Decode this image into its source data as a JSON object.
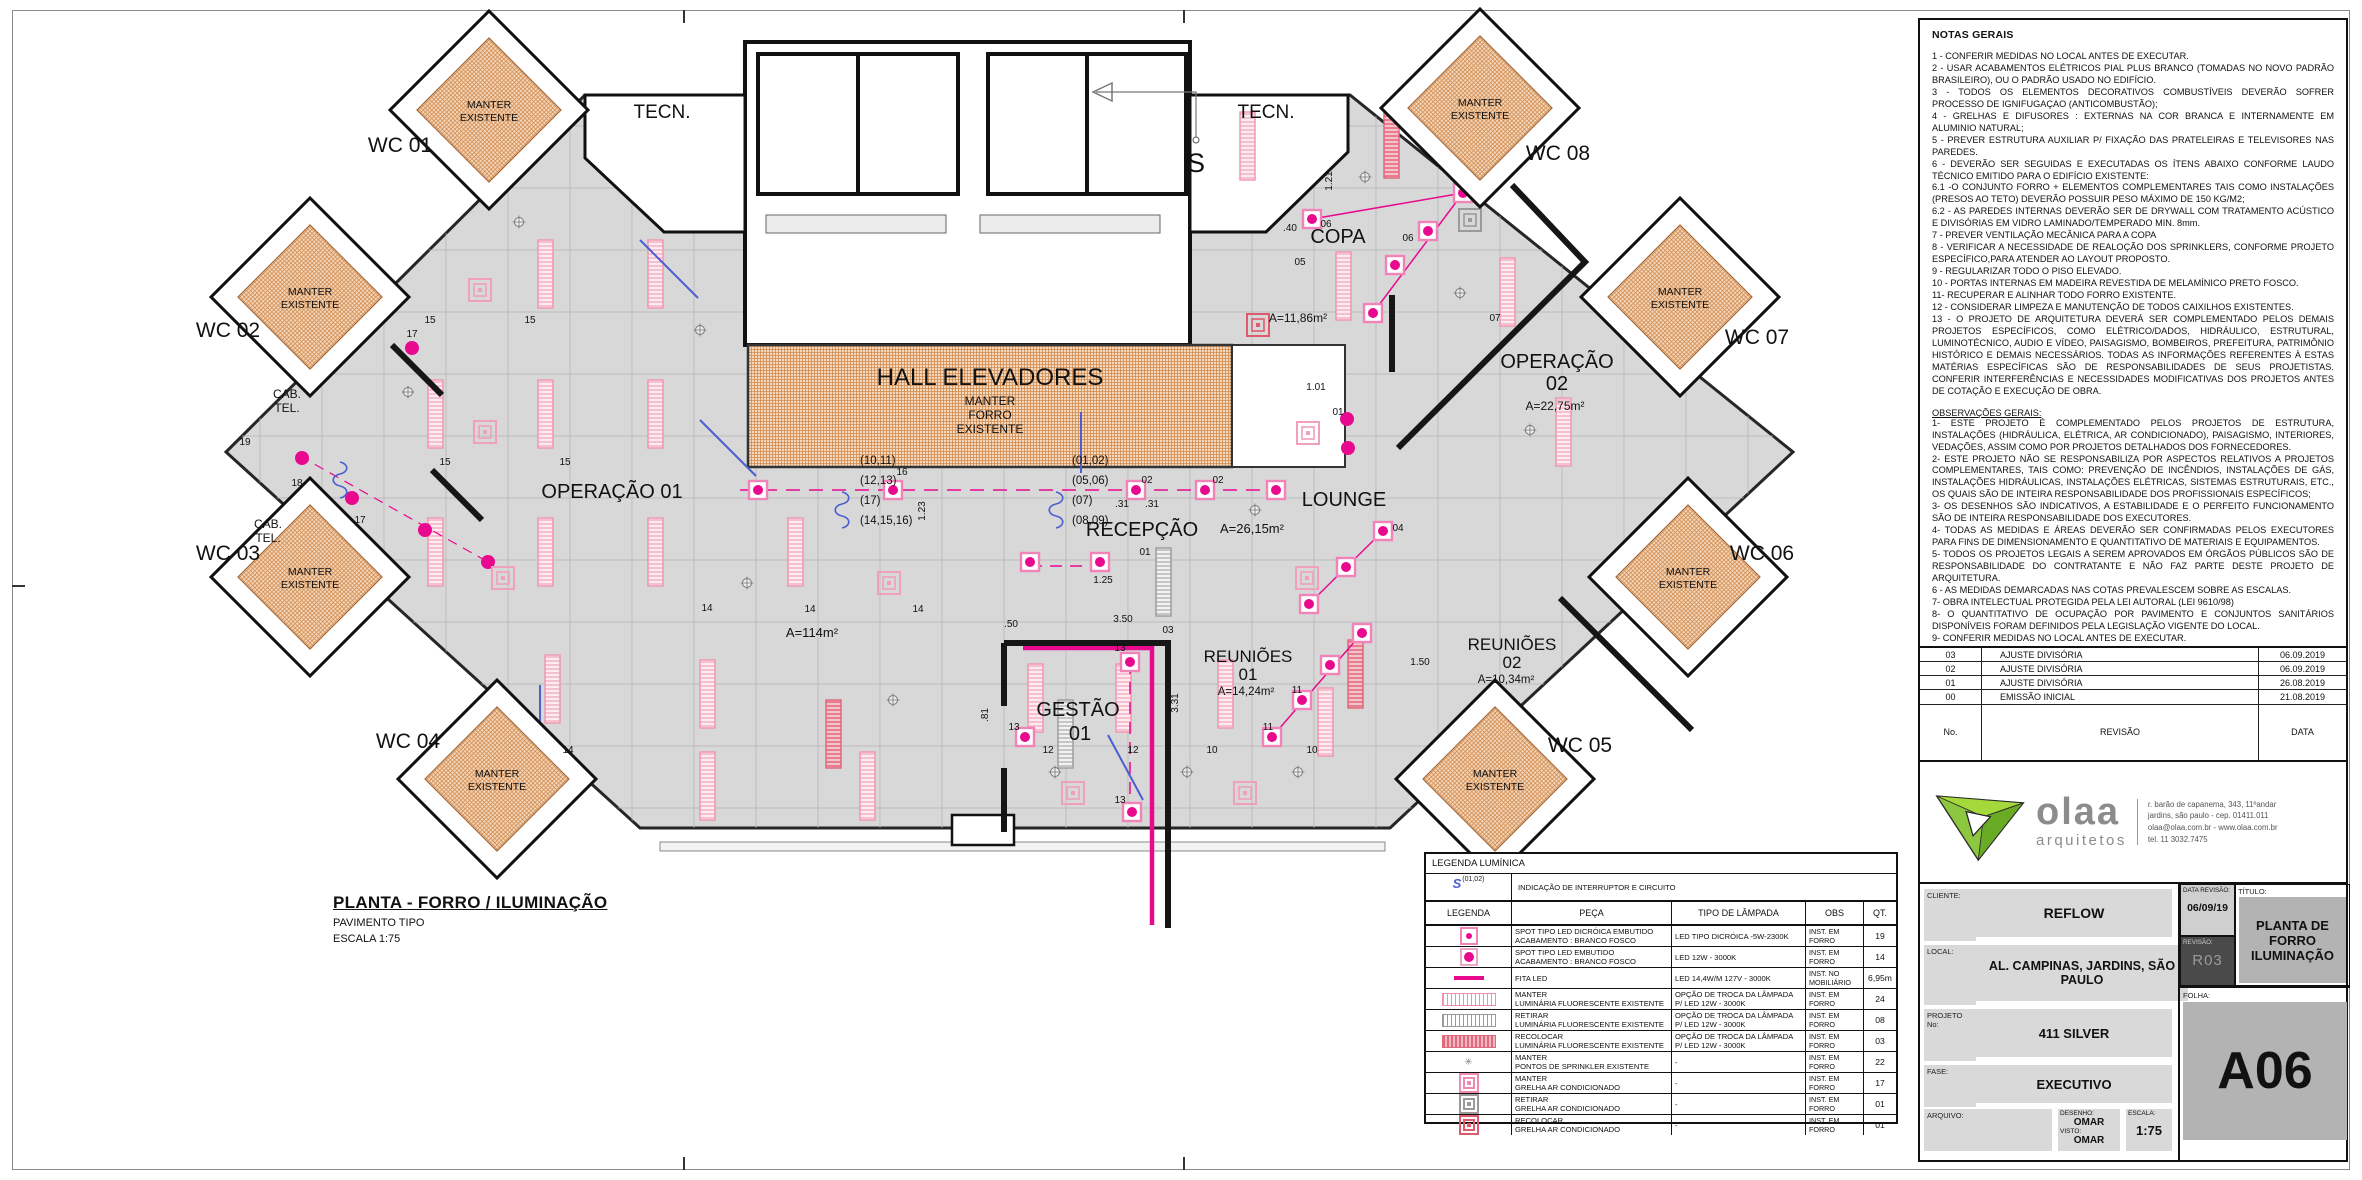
{
  "colors": {
    "magenta": "#e8098e",
    "pink_fixture": "#ef93ac",
    "orange_hatch": "#d08a4e",
    "switch_blue": "#4a5fd0",
    "logo_green": "#8dc63f"
  },
  "sheet": {
    "plan_title": "PLANTA - FORRO / ILUMINAÇÃO",
    "plan_subtitle": "PAVIMENTO TIPO",
    "plan_scale": "ESCALA 1:75"
  },
  "notes": {
    "title": "NOTAS GERAIS",
    "items": [
      "1 - CONFERIR MEDIDAS NO LOCAL ANTES DE EXECUTAR.",
      "2 - USAR ACABAMENTOS ELÉTRICOS PIAL PLUS BRANCO (TOMADAS NO NOVO PADRÃO BRASILEIRO), OU O PADRÃO USADO NO EDIFÍCIO.",
      "3 - TODOS OS ELEMENTOS DECORATIVOS COMBUSTÍVEIS DEVERÃO SOFRER PROCESSO DE IGNIFUGAÇAO (ANTICOMBUSTÃO);",
      "4 - GRELHAS E DIFUSORES :  EXTERNAS NA COR BRANCA E INTERNAMENTE EM ALUMINIO NATURAL;",
      "5 - PREVER ESTRUTURA AUXILIAR P/ FIXAÇÃO DAS PRATELEIRAS E TELEVISORES NAS PAREDES.",
      "6 - DEVERÃO SER SEGUIDAS E EXECUTADAS OS ÍTENS ABAIXO CONFORME  LAUDO TÉCNICO EMITIDO PARA O  EDIFÍCIO EXISTENTE:",
      "6.1 -O CONJUNTO  FORRO + ELEMENTOS COMPLEMENTARES TAIS COMO INSTALAÇÕES (PRESOS AO TETO) DEVERÃO POSSUIR PESO MÁXIMO DE 150 KG/M2;",
      "6.2 - AS PAREDES INTERNAS DEVERÃO SER DE DRYWALL COM TRATAMENTO ACÚSTICO E DIVISÓRIAS EM VIDRO LAMINADO/TEMPERADO MIN. 8mm.",
      "7 -  PREVER VENTILAÇÃO MECÂNICA PARA A COPA",
      "8 - VERIFICAR A NECESSIDADE DE REALOÇÃO DOS SPRINKLERS, CONFORME PROJETO ESPECÍFICO,PARA ATENDER AO LAYOUT PROPOSTO.",
      "9 - REGULARIZAR TODO O PISO ELEVADO.",
      "10 - PORTAS INTERNAS EM MADEIRA REVESTIDA DE MELAMÍNICO PRETO FOSCO.",
      "11- RECUPERAR E ALINHAR TODO FORRO EXISTENTE.",
      "12 - CONSIDERAR LIMPEZA E MANUTENÇÃO DE TODOS CAIXILHOS EXISTENTES.",
      "13 - O PROJETO DE ARQUITETURA DEVERÁ SER COMPLEMENTADO PELOS DEMAIS PROJETOS ESPECÍFICOS, COMO ELÉTRICO/DADOS, HIDRÁULICO, ESTRUTURAL, LUMINOTÉCNICO, AUDIO E VÍDEO, PAISAGISMO, BOMBEIROS, PREFEITURA, PATRIMÔNIO HISTÓRICO E DEMAIS NECESSÁRIOS. TODAS AS INFORMAÇÕES REFERENTES À ESTAS MATÉRIAS ESPECÍFICAS SÃO DE RESPONSABILIDADES DE SEUS PROJETISTAS. CONFERIR INTERFERÊNCIAS E NECESSIDADES MODIFICATIVAS DOS PROJETOS ANTES DE COTAÇÃO E EXECUÇÃO DE OBRA."
    ],
    "obs_title": "OBSERVAÇÕES GERAIS:",
    "obs_items": [
      "1-  ESTE PROJETO É COMPLEMENTADO PELOS PROJETOS DE ESTRUTURA, INSTALAÇÕES (HIDRÁULICA, ELÉTRICA, AR CONDICIONADO), PAISAGISMO, INTERIORES, VEDAÇÕES, ASSIM COMO POR PROJETOS DETALHADOS DOS FORNECEDORES.",
      "2- ESTE PROJETO NÃO SE RESPONSABILIZA POR ASPECTOS RELATIVOS A PROJETOS COMPLEMENTARES, TAIS COMO: PREVENÇÃO DE INCÊNDIOS, INSTALAÇÕES DE GÁS, INSTALAÇÕES HIDRÁULICAS, INSTALAÇÕES ELÉTRICAS, SISTEMAS ESTRUTURAIS, ETC., OS QUAIS SÃO DE INTEIRA RESPONSABILIDADE DOS PROFISSIONAIS ESPECÍFICOS;",
      "3-  OS DESENHOS SÃO INDICATIVOS, A ESTABILIDADE E O PERFEITO FUNCIONAMENTO SÃO DE INTEIRA RESPONSABILIDADE DOS EXECUTORES.",
      "4- TODAS AS MEDIDAS E ÁREAS DEVERÃO SER CONFIRMADAS PELOS EXECUTORES PARA FINS DE DIMENSIONAMENTO E QUANTITATIVO DE MATERIAIS  E EQUIPAMENTOS.",
      "5- TODOS OS PROJETOS LEGAIS A SEREM APROVADOS EM ÓRGÃOS PÚBLICOS SÃO DE RESPONSABILIDADE DO CONTRATANTE E NÃO FAZ PARTE DESTE PROJETO DE ARQUITETURA.",
      "6 -  AS MEDIDAS DEMARCADAS NAS COTAS PREVALESCEM SOBRE AS ESCALAS.",
      "7-  OBRA INTELECTUAL PROTEGIDA PELA LEI AUTORAL (LEI 9610/98)",
      "8- O QUANTITATIVO DE OCUPAÇÃO POR PAVIMENTO E CONJUNTOS SANITÁRIOS DISPONÍVEIS FORAM DEFINIDOS PELA LEGISLAÇÃO VIGENTE DO LOCAL.",
      "9-  CONFERIR MEDIDAS NO LOCAL ANTES DE EXECUTAR.",
      "10- AS QUANTIDADES DOS ITENS DEMONSTRADOS EM PLANTA, PREVALESCEM SOBRE QUANTITATIVOS DO MEMORIAL E LEGENDAS."
    ]
  },
  "revisions": {
    "rows": [
      {
        "no": "03",
        "desc": "AJUSTE  DIVISÓRIA",
        "date": "06.09.2019"
      },
      {
        "no": "02",
        "desc": "AJUSTE  DIVISÓRIA",
        "date": "06.09.2019"
      },
      {
        "no": "01",
        "desc": "AJUSTE  DIVISÓRIA",
        "date": "26.08.2019"
      },
      {
        "no": "00",
        "desc": "EMISSÃO INICIAL",
        "date": "21.08.2019"
      }
    ],
    "footer": {
      "no": "No.",
      "desc": "REVISÃO",
      "date": "DATA"
    }
  },
  "logo": {
    "name": "olaa",
    "sub": "arquitetos",
    "address_lines": [
      "r. barão de capanema, 343, 11ºandar",
      "jardins, são paulo - cep. 01411.011",
      "olaa@olaa.com.br - www.olaa.com.br",
      "tel. 11 3032.7475"
    ]
  },
  "titleblock": {
    "cliente_label": "CLIENTE:",
    "cliente": "REFLOW",
    "local_label": "LOCAL:",
    "local": "AL. CAMPINAS, JARDINS, SÃO PAULO",
    "projeto_label": "PROJETO No:",
    "projeto": "411 SILVER",
    "fase_label": "FASE:",
    "fase": "EXECUTIVO",
    "arquivo_label": "ARQUIVO:",
    "desenho_label": "DESENHO:",
    "desenho": "OMAR",
    "visto_label": "VISTO:",
    "visto": "OMAR",
    "escala_label": "ESCALA:",
    "escala": "1:75",
    "data_revisao_label": "DATA REVISÃO:",
    "data_revisao": "06/09/19",
    "revisao_label": "REVISÃO:",
    "revisao": "R03",
    "titulo_label": "TÍTULO:",
    "titulo": "PLANTA DE FORRO ILUMINAÇÃO",
    "folha_label": "FOLHA:",
    "folha": "A06"
  },
  "legend": {
    "title": "LEGENDA LUMÍNICA",
    "interruptor_symbol": "S",
    "interruptor_circuit": "(01,02)",
    "interruptor_desc": "INDICAÇÃO DE INTERRUPTOR E CIRCUITO",
    "headers": [
      "LEGENDA",
      "PEÇA",
      "TIPO DE LÂMPADA",
      "OBS",
      "QT."
    ],
    "rows": [
      {
        "icon": "spot-dicroica",
        "peca1": "SPOT TIPO LED DICRÓICA EMBUTIDO",
        "peca2": "ACABAMENTO : BRANCO FOSCO",
        "tipo": "LED TIPO DICRÓICA -5W-2300K",
        "obs": "INST. EM FORRO",
        "qt": "19"
      },
      {
        "icon": "spot-led",
        "peca1": "SPOT TIPO LED EMBUTIDO",
        "peca2": "ACABAMENTO : BRANCO FOSCO",
        "tipo": "LED 12W - 3000K",
        "obs": "INST. EM FORRO",
        "qt": "14"
      },
      {
        "icon": "fita-led",
        "peca1": "FITA LED",
        "peca2": "",
        "tipo": "LED 14,4W/M 127V - 3000K",
        "obs": "INST. NO MOBILIÁRIO",
        "qt": "6,95m"
      },
      {
        "icon": "fluor-manter",
        "peca1": "MANTER",
        "peca2": "LUMINÁRIA FLUORESCENTE EXISTENTE",
        "tipo": "OPÇÃO DE TROCA DA LÂMPADA P/ LED 12W - 3000K",
        "obs": "INST. EM FORRO",
        "qt": "24"
      },
      {
        "icon": "fluor-retirar",
        "peca1": "RETIRAR",
        "peca2": "LUMINÁRIA FLUORESCENTE EXISTENTE",
        "tipo": "OPÇÃO DE TROCA DA LÂMPADA P/ LED 12W - 3000K",
        "obs": "INST. EM FORRO",
        "qt": "08"
      },
      {
        "icon": "fluor-recolocar",
        "peca1": "RECOLOCAR",
        "peca2": "LUMINÁRIA FLUORESCENTE EXISTENTE",
        "tipo": "OPÇÃO DE TROCA DA LÂMPADA P/ LED 12W - 3000K",
        "obs": "INST. EM FORRO",
        "qt": "03"
      },
      {
        "icon": "sprinkler",
        "peca1": "MANTER",
        "peca2": "PONTOS DE SPRINKLER EXISTENTE",
        "tipo": "-",
        "obs": "INST. EM FORRO",
        "qt": "22"
      },
      {
        "icon": "grelha-manter",
        "peca1": "MANTER",
        "peca2": "GRELHA  AR CONDICIONADO",
        "tipo": "-",
        "obs": "INST. EM FORRO",
        "qt": "17"
      },
      {
        "icon": "grelha-retirar",
        "peca1": "RETIRAR",
        "peca2": "GRELHA  AR CONDICIONADO",
        "tipo": "-",
        "obs": "INST. EM FORRO",
        "qt": "01"
      },
      {
        "icon": "grelha-recolocar",
        "peca1": "RECOLOCAR",
        "peca2": "GRELHA  AR CONDICIONADO",
        "tipo": "-",
        "obs": "INST. EM FORRO",
        "qt": "01"
      }
    ]
  },
  "plan": {
    "tecn": "TECN.",
    "wcs": [
      "WC 01",
      "WC 02",
      "WC 03",
      "WC 04",
      "WC 05",
      "WC 06",
      "WC 07",
      "WC 08"
    ],
    "manter_l1": "MANTER",
    "manter_l2": "EXISTENTE",
    "hall_title": "HALL ELEVADORES",
    "hall_sub": [
      "MANTER",
      "FORRO",
      "EXISTENTE"
    ],
    "rooms": {
      "operacao01": "OPERAÇÃO 01",
      "operacao01_area": "A=114m²",
      "recepcao": "RECEPÇÃO",
      "recepcao_area": "A=26,15m²",
      "lounge": "LOUNGE",
      "copa": "COPA",
      "copa_area": "A=11,86m²",
      "operacao02_l1": "OPERAÇÃO",
      "operacao02_l2": "02",
      "operacao02_area": "A=22,75m²",
      "gestao_l1": "GESTÃO",
      "gestao_l2": "01",
      "reunioes": "REUNIÕES",
      "reunioes01_num": "01",
      "reunioes01_area": "A=14,24m²",
      "reunioes02_num": "02",
      "reunioes02_area": "A=10,34m²",
      "cab_l1": "CAB.",
      "cab_l2": "TEL."
    },
    "s_marker": "S",
    "circuits_left": [
      "(10,11)",
      "(12,13)",
      "(17)",
      "(14,15,16)"
    ],
    "circuits_right": [
      "(01,02)",
      "(05,06)",
      "(07)",
      "(08,09)"
    ],
    "dims": [
      "1.01",
      "1.21",
      "1.23",
      "1.25",
      "3.50",
      ".31",
      ".31",
      ".50",
      "3.31",
      ".81",
      ".40",
      "1.50"
    ],
    "nums": [
      "15",
      "15",
      "15",
      "15",
      "14",
      "14",
      "14",
      "14",
      "16",
      "17",
      "17",
      "18",
      "19",
      "12",
      "12",
      "13",
      "13",
      "13",
      "10",
      "10",
      "11",
      "11",
      "06",
      "06",
      "02",
      "02",
      "01",
      "01",
      "03",
      "04",
      "05",
      "07"
    ]
  }
}
